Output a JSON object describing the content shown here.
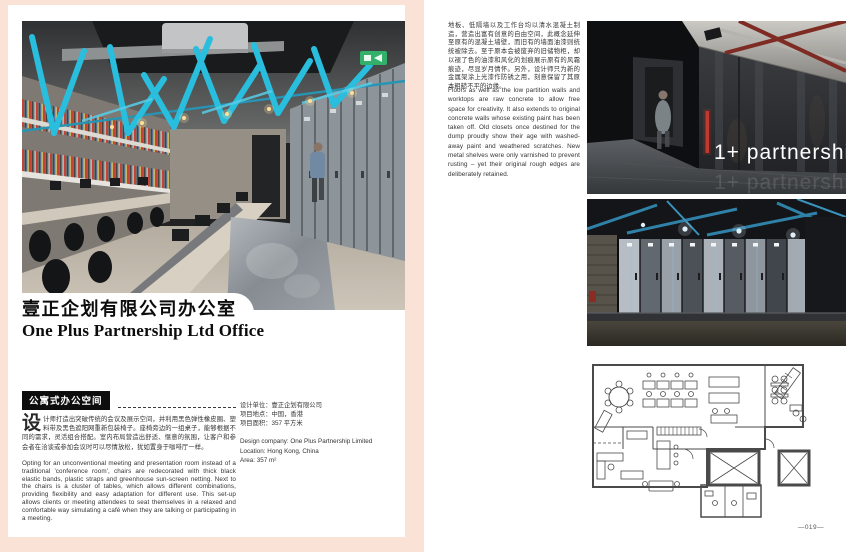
{
  "left_page": {
    "title_zh": "壹正企划有限公司办公室",
    "title_en": "One Plus Partnership Ltd Office",
    "tag": "公寓式办公空间",
    "dropcap": "设",
    "body_zh": "计师打造出突破传统的会议及展示空间，并利用黑色弹性橡皮圈、塑料带及黑色遮阳网重新包装椅子。座椅旁边的一组桌子，能够根据不同的需求，灵活组合搭配。室内布局营造出舒适、惬意的氛围，让客户和参会者在洽谈或参加会议时可以尽情放松，犹如置身于咖啡厅一样。",
    "body_en": "Opting for an unconventional meeting and presentation room instead of a traditional 'conference room', chairs are redecorated with thick black elastic bands, plastic straps and greenhouse sun-screen netting. Next to the chairs is a cluster of tables, which allows different combinations, providing flexibility and easy adaptation for different use. This set-up allows clients or meeting attendees to seat themselves in a relaxed and comfortable way simulating a café when they are talking or participating in a meeting.",
    "info": {
      "design_company_zh": "设计单位：壹正企划有限公司",
      "location_zh": "项目地点：中国，香港",
      "area_zh": "项目面积：357 平方米",
      "design_company_en": "Design company: One Plus Partnership Limited",
      "location_en": "Location: Hong Kong, China",
      "area_en": "Area: 357 m²"
    }
  },
  "right_page": {
    "body_zh": "地板、低隔墙以及工作台均以清水混凝土制造，营造出富有创意的自由空间，此概念延伸至原有的混凝土墙壁，而旧有的墙面油漆则统统被除去。至于原本会被废弃的旧储物柜，却以褪了色的油漆和风化的划痕展示原有的风霜痕迹，尽显岁月情怀。另外，设计师只为新的金属架涂上光漆作防锈之用，刻意保留了其原本粗糙不平的边缘。",
    "body_en": "Floors as well as the low partition walls and worktops are raw concrete to allow free space for creativity. It also extends to original concrete walls whose existing paint has been taken off. Old closets once destined for the dump proudly show their age with washed-away paint and weathered scratches. New metal shelves were only varnished to prevent rusting – yet their original rough edges are deliberately retained.",
    "photo1_text": "1+ partnership",
    "page_number": "—019—"
  },
  "colors": {
    "background_pink": "#fae3d6",
    "accent_cyan": "#29bede",
    "pipe_red": "#7e2b24",
    "pipe_blue": "#2f81a8",
    "exit_green": "#33b06a",
    "tag_black": "#0d0d0d"
  }
}
